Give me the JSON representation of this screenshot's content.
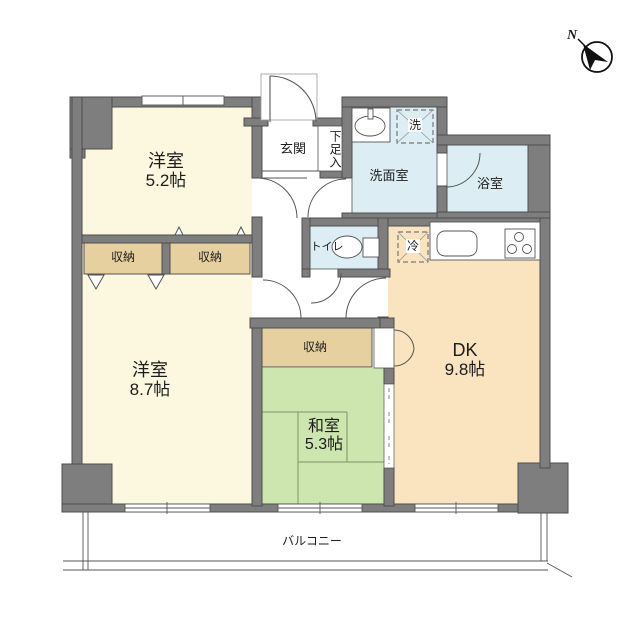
{
  "title": "2DK floor plan",
  "compass": {
    "north": "N"
  },
  "rooms": {
    "western_1": {
      "name": "洋室",
      "size": "5.2帖"
    },
    "western_2": {
      "name": "洋室",
      "size": "8.7帖"
    },
    "japanese": {
      "name": "和室",
      "size": "5.3帖"
    },
    "dining_kitchen": {
      "name": "DK",
      "size": "9.8帖"
    },
    "entrance": "玄関",
    "shoe_cabinet": "下足入",
    "washroom": "洗面室",
    "bathroom": "浴室",
    "toilet": "トイレ",
    "closet_a": "収納",
    "closet_b": "収納",
    "closet_c": "収納",
    "washer": "洗",
    "fridge": "冷",
    "balcony": "バルコニー"
  },
  "colors": {
    "wall": "#7e7e7e",
    "wall_edge": "#4e4e4e",
    "western_room": "#fbf8df",
    "closet": "#e6d0a0",
    "tatami": "#cde5af",
    "dk": "#fae4c0",
    "wet_room": "#dceef3",
    "line": "#555555"
  }
}
